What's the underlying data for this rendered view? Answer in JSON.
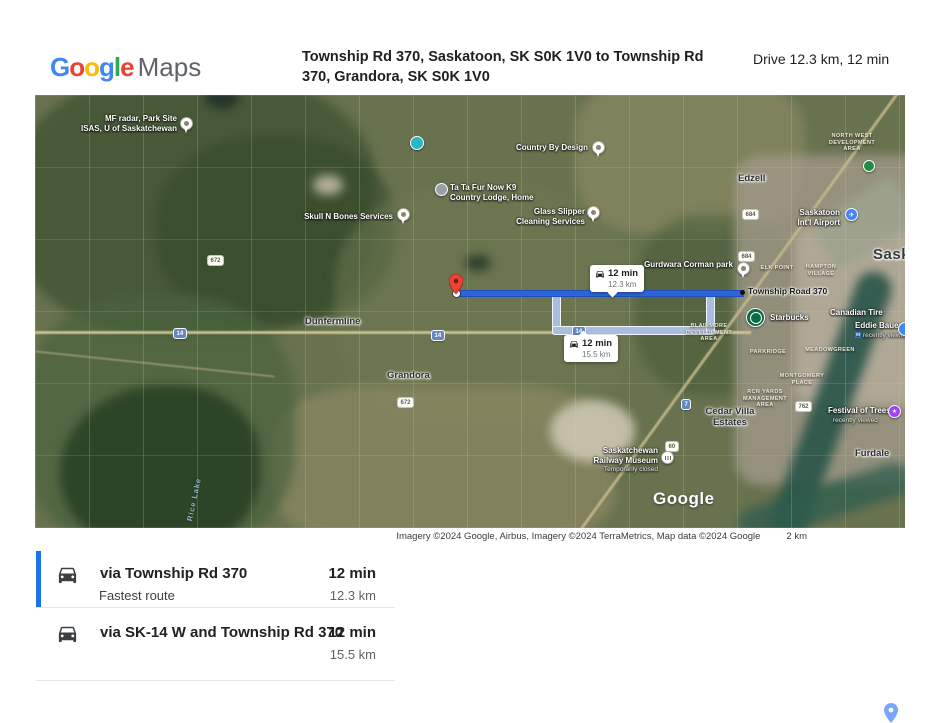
{
  "header": {
    "logo_letters": [
      "G",
      "o",
      "o",
      "g",
      "l",
      "e"
    ],
    "logo_colors": [
      "#4285F4",
      "#EA4335",
      "#FBBC05",
      "#4285F4",
      "#34A853",
      "#EA4335"
    ],
    "logo_maps": "Maps",
    "title": "Township Rd 370, Saskatoon, SK S0K 1V0 to Township Rd 370, Grandora, SK S0K 1V0",
    "drive_summary": "Drive 12.3 km, 12 min"
  },
  "map": {
    "watermark": "Google",
    "attribution": "Imagery ©2024 Google, Airbus, Imagery ©2024 TerraMetrics, Map data ©2024 Google",
    "scale_label": "2 km",
    "destination": {
      "label": "Township Road 370"
    },
    "callouts": [
      {
        "time": "12 min",
        "distance": "12.3 km"
      },
      {
        "time": "12 min",
        "distance": "15.5 km"
      }
    ],
    "shields": {
      "s672a": "672",
      "s14a": "14",
      "s14b": "14",
      "s14c": "14",
      "s672b": "672",
      "s684a": "684",
      "s684b": "684",
      "s7": "7",
      "s762": "762",
      "s60": "60"
    },
    "pois": {
      "mf_radar": {
        "l1": "MF radar, Park Site",
        "l2": "ISAS, U of Saskatchewan"
      },
      "country_by_design": {
        "l1": "Country By Design"
      },
      "ta_ta_fur": {
        "l1": "Ta Ta Fur Now K9",
        "l2": "Country Lodge, Home"
      },
      "skull_n_bones": {
        "l1": "Skull N Bones Services"
      },
      "glass_slipper": {
        "l1": "Glass Slipper",
        "l2": "Cleaning Services"
      },
      "gurdwara": {
        "l1": "Gurdwara Corman park"
      },
      "airport": {
        "l1": "Saskatoon",
        "l2": "Int'l Airport"
      },
      "starbucks": {
        "l1": "Starbucks"
      },
      "canadian_tire": {
        "l1": "Canadian Tire"
      },
      "eddie_bauer": {
        "l1": "Eddie Bauer",
        "l2": "recently viewed"
      },
      "festival_of_trees": {
        "l1": "Festival of Trees",
        "l2": "recently viewed"
      },
      "railway_museum": {
        "l1": "Saskatchewan",
        "l2": "Railway Museum",
        "l3": "Temporarily closed"
      }
    },
    "places": {
      "edzell": "Edzell",
      "dunfermline": "Dunfermline",
      "grandora": "Grandora",
      "furdale": "Furdale",
      "saskatoon_city": "Saskatoon",
      "rice_lake": "Rice Lake"
    },
    "areas": {
      "north_west": {
        "l1": "NORTH WEST",
        "l2": "DEVELOPMENT",
        "l3": "AREA"
      },
      "elk_point": {
        "l1": "ELK POINT"
      },
      "hampton": {
        "l1": "HAMPTON",
        "l2": "VILLAGE"
      },
      "blairmore": {
        "l1": "BLAIRMORE",
        "l2": "DEVELOPMENT",
        "l3": "AREA"
      },
      "parkridge": {
        "l1": "PARKRIDGE"
      },
      "meadowgreen": {
        "l1": "MEADOWGREEN"
      },
      "montgomery": {
        "l1": "MONTGOMERY",
        "l2": "PLACE"
      },
      "rcn_yards": {
        "l1": "RCN YARDS",
        "l2": "MANAGEMENT",
        "l3": "AREA"
      },
      "cedar_villa": {
        "l1": "Cedar Villa",
        "l2": "Estates"
      }
    }
  },
  "directions": {
    "options": [
      {
        "via": "via Township Rd 370",
        "duration": "12 min",
        "note": "Fastest route",
        "distance": "12.3 km"
      },
      {
        "via": "via SK-14 W and Township Rd 370",
        "duration": "12 min",
        "distance": "15.5 km"
      }
    ]
  },
  "colors": {
    "accent_blue": "#1a73e8",
    "route_primary": "#2e64d8",
    "route_alternate": "#a9bedf",
    "origin_pin_red": "#ea4335"
  }
}
